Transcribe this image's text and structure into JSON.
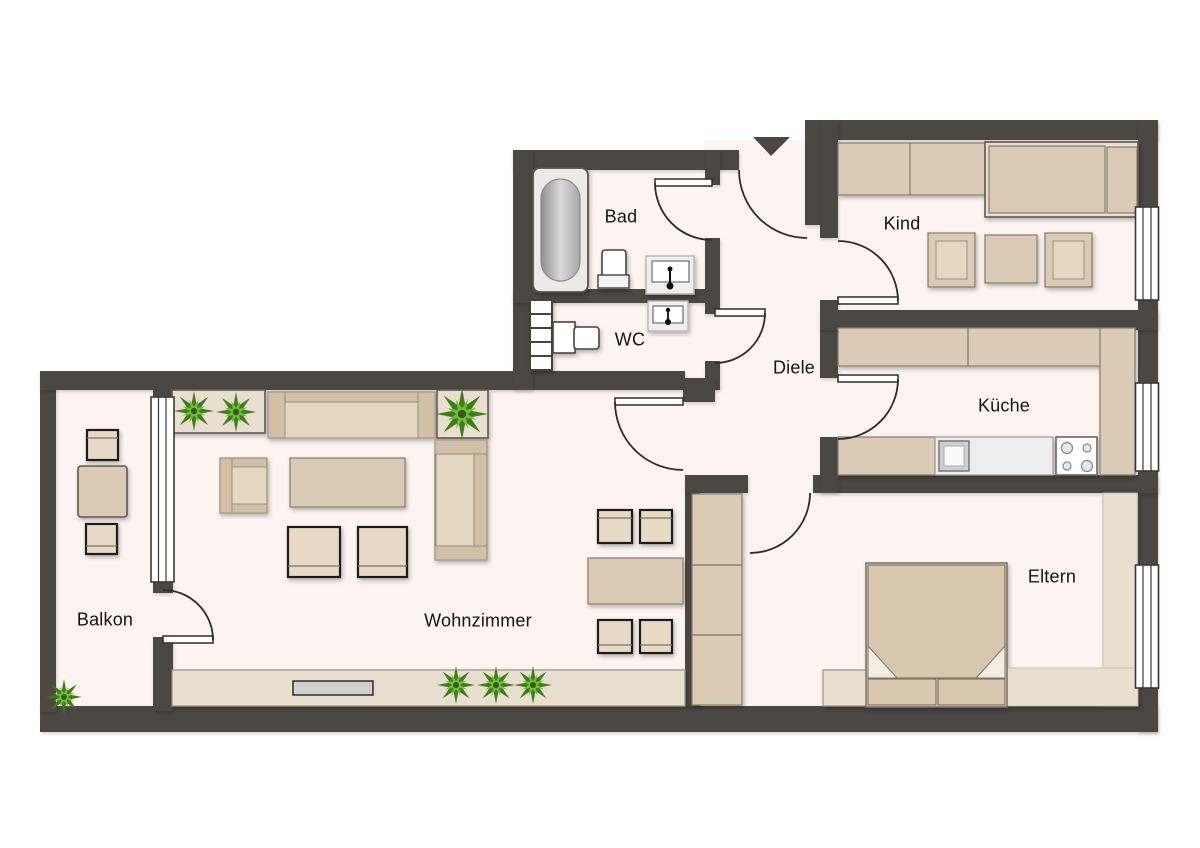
{
  "floorplan": {
    "rooms": {
      "bad": {
        "label": "Bad"
      },
      "wc": {
        "label": "WC"
      },
      "diele": {
        "label": "Diele"
      },
      "kind": {
        "label": "Kind"
      },
      "kueche": {
        "label": "Küche"
      },
      "wohnzimmer": {
        "label": "Wohnzimmer"
      },
      "balkon": {
        "label": "Balkon"
      },
      "eltern": {
        "label": "Eltern"
      }
    },
    "icons": {
      "entrance": "entrance-arrow-down"
    },
    "colors": {
      "wall": "#4b4743",
      "floor": "#fdf3f1",
      "furniture": "#d9cbb5",
      "furniture_light": "#e8dfd0",
      "plant_green": "#5a9426",
      "background": "#ffffff"
    }
  }
}
